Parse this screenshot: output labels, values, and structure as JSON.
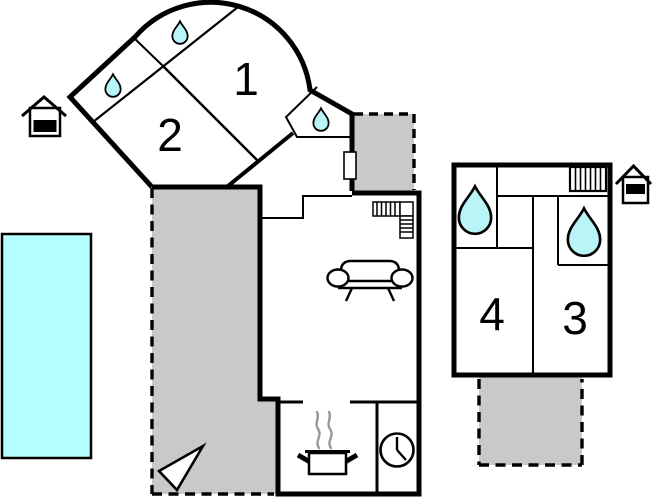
{
  "floorplan": {
    "title": "Vacation house floor plan",
    "rooms": {
      "room1": "1",
      "room2": "2",
      "room3": "3",
      "room4": "4"
    },
    "colors": {
      "wall": "#000000",
      "terrace": "#c9c9c9",
      "pool": "#b3feff",
      "water": "#b9f4f7",
      "steam": "#999999",
      "background": "#ffffff"
    },
    "icons": [
      "water-drop-icon",
      "sofa-icon",
      "cooking-pot-icon",
      "clock-icon",
      "stairs-icon",
      "radiator-icon",
      "pool",
      "compass-arrow-icon",
      "outbuilding-icon",
      "entry-door"
    ]
  }
}
